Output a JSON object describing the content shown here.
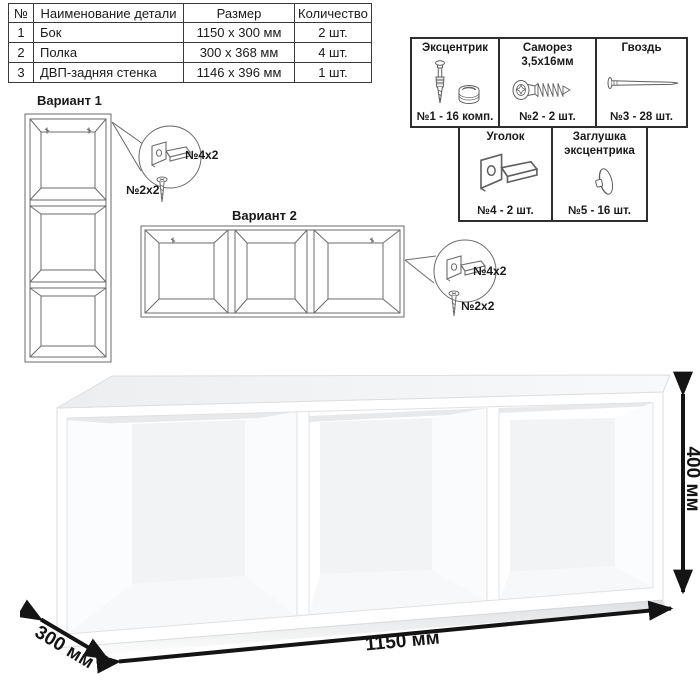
{
  "parts_table": {
    "headers": {
      "num": "№",
      "name": "Наименование детали",
      "size": "Размер",
      "qty": "Количество"
    },
    "rows": [
      {
        "num": "1",
        "name": "Бок",
        "size": "1150 x 300 мм",
        "qty": "2 шт."
      },
      {
        "num": "2",
        "name": "Полка",
        "size": "300 x 368 мм",
        "qty": "4 шт."
      },
      {
        "num": "3",
        "name": "ДВП-задняя стенка",
        "size": "1146 x 396 мм",
        "qty": "1 шт."
      }
    ]
  },
  "hardware_legend": {
    "items": [
      {
        "icon": "cam-lock-icon",
        "title_line1": "Эксцентрик",
        "title_line2": "",
        "count": "№1 - 16 комп."
      },
      {
        "icon": "screw-icon",
        "title_line1": "Саморез",
        "title_line2": "3,5х16мм",
        "count": "№2 - 2 шт."
      },
      {
        "icon": "nail-icon",
        "title_line1": "Гвоздь",
        "title_line2": "",
        "count": "№3 - 28 шт."
      },
      {
        "icon": "corner-bracket-icon",
        "title_line1": "Уголок",
        "title_line2": "",
        "count": "№4 - 2 шт."
      },
      {
        "icon": "cam-cap-icon",
        "title_line1": "Заглушка",
        "title_line2": "эксцентрика",
        "count": "№5 - 16 шт."
      }
    ]
  },
  "variant1": {
    "label": "Вариант 1",
    "bracket_qty": "№4х2",
    "screw_qty": "№2х2"
  },
  "variant2": {
    "label": "Вариант 2",
    "bracket_qty": "№4х2",
    "screw_qty": "№2х2"
  },
  "dimensions": {
    "width_label": "1150 мм",
    "height_label": "400 мм",
    "depth_label": "300 мм"
  },
  "colors": {
    "drawing_line": "#6b6b6b",
    "table_border": "#3a3a3a",
    "dimension_arrow": "#141414"
  }
}
